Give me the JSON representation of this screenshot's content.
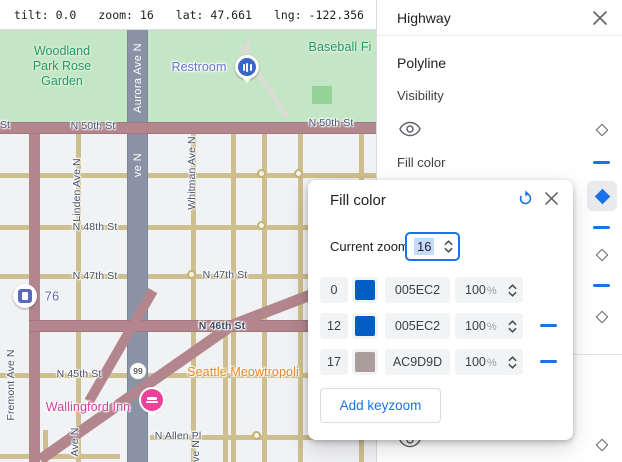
{
  "statusbar": {
    "tilt_label": "tilt:",
    "tilt": "0.0",
    "zoom_label": "zoom:",
    "zoom": "16",
    "lat_label": "lat:",
    "lat": "47.661",
    "lng_label": "lng:",
    "lng": "-122.356"
  },
  "panel": {
    "title": "Highway",
    "section": "Polyline",
    "visibility_label": "Visibility",
    "fill_color_label": "Fill color"
  },
  "dialog": {
    "title": "Fill color",
    "current_zoom_label": "Current zoom",
    "current_zoom": "16",
    "percent_sign": "%",
    "rows": [
      {
        "zoom": "0",
        "hex": "005EC2",
        "color": "#005EC2",
        "opacity": "100",
        "removable": false
      },
      {
        "zoom": "12",
        "hex": "005EC2",
        "color": "#005EC2",
        "opacity": "100",
        "removable": true
      },
      {
        "zoom": "17",
        "hex": "AC9D9D",
        "color": "#AC9D9D",
        "opacity": "100",
        "removable": true
      }
    ],
    "add_button": "Add keyzoom"
  },
  "map": {
    "park_line1": "Woodland",
    "park_line2": "Park Rose",
    "park_line3": "Garden",
    "baseball": "Baseball Fi",
    "restroom": "Restroom",
    "gas_label": "76",
    "shield": "99",
    "poi_orange": "Seattle Meowtropoli",
    "inn": "Wallingford Inn",
    "streets": {
      "st_frag": "St",
      "n50": "N 50th St",
      "n50b": "N 50th St",
      "n48": "N 48th St",
      "n47": "N 47th St",
      "n47b": "N 47th St",
      "n46": "N 46th St",
      "n45": "N 45th St",
      "allen": "N Allen Pl",
      "aurora": "Aurora Ave N",
      "aurora_frag": "ve N",
      "linden": "Linden Ave N",
      "whitman": "Whitman Ave N",
      "fremont": "Fremont Ave N",
      "aven_frag": "Ave N",
      "aven_frag2": "ve N"
    }
  },
  "icons": {
    "close": "x-cross",
    "reset": "rotate-left-arrow",
    "visibility": "eye-outline",
    "keyzoom_marker": "diamond",
    "keyzoom_dash": "horizontal-dash",
    "stepper": "up-down-chevrons"
  },
  "colors": {
    "accent_blue": "#1a73e8",
    "chip_grey": "#f1f3f4",
    "park_green": "#c5e6c5",
    "highway_mauve": "#b2868c",
    "road_yellow": "#cec08e",
    "aurora_grey": "#8a93a6",
    "pin_pink": "#e9449a",
    "poi_orange": "#ec8420"
  }
}
